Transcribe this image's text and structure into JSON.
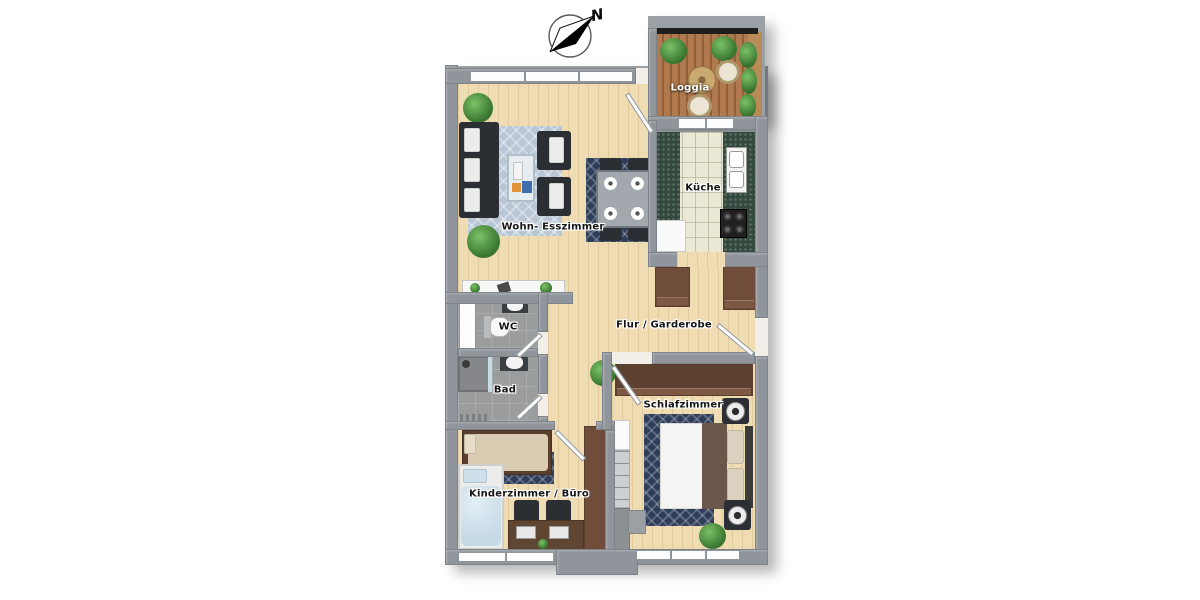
{
  "page": {
    "type": "apartment-floorplan-3d-top-view",
    "background": "#ffffff"
  },
  "compass": {
    "label": "N",
    "direction": "northeast"
  },
  "rooms": {
    "loggia": {
      "label": "Loggia"
    },
    "kitchen": {
      "label": "Küche"
    },
    "living": {
      "label": "Wohn- Esszimmer"
    },
    "wc": {
      "label": "WC"
    },
    "bath": {
      "label": "Bad"
    },
    "hall": {
      "label": "Flur / Garderobe"
    },
    "bedroom": {
      "label": "Schlafzimmer"
    },
    "kids_room": {
      "label": "Kinderzimmer / Büro"
    }
  },
  "palette": {
    "wall_gray": "#8f959b",
    "wood_floor": "#efdcb2",
    "kitchen_tile": "#ece8d6",
    "bath_floor": "#9b9c9e",
    "loggia_deck": "#a9724b",
    "kitchen_counter_green": "#34493e",
    "wardrobe_brown": "#6f4d3a",
    "sofa_dark": "#2b2e33",
    "rug_light_blue": "#b9c6d6",
    "rug_navy": "#2e3d59",
    "plant_green": "#3c7a33",
    "kids_bedding_blue": "#cfe0ea",
    "kids_blanket_beige": "#d8cbb2",
    "label_text": "#141414",
    "loggia_label_text": "#ffffff"
  }
}
